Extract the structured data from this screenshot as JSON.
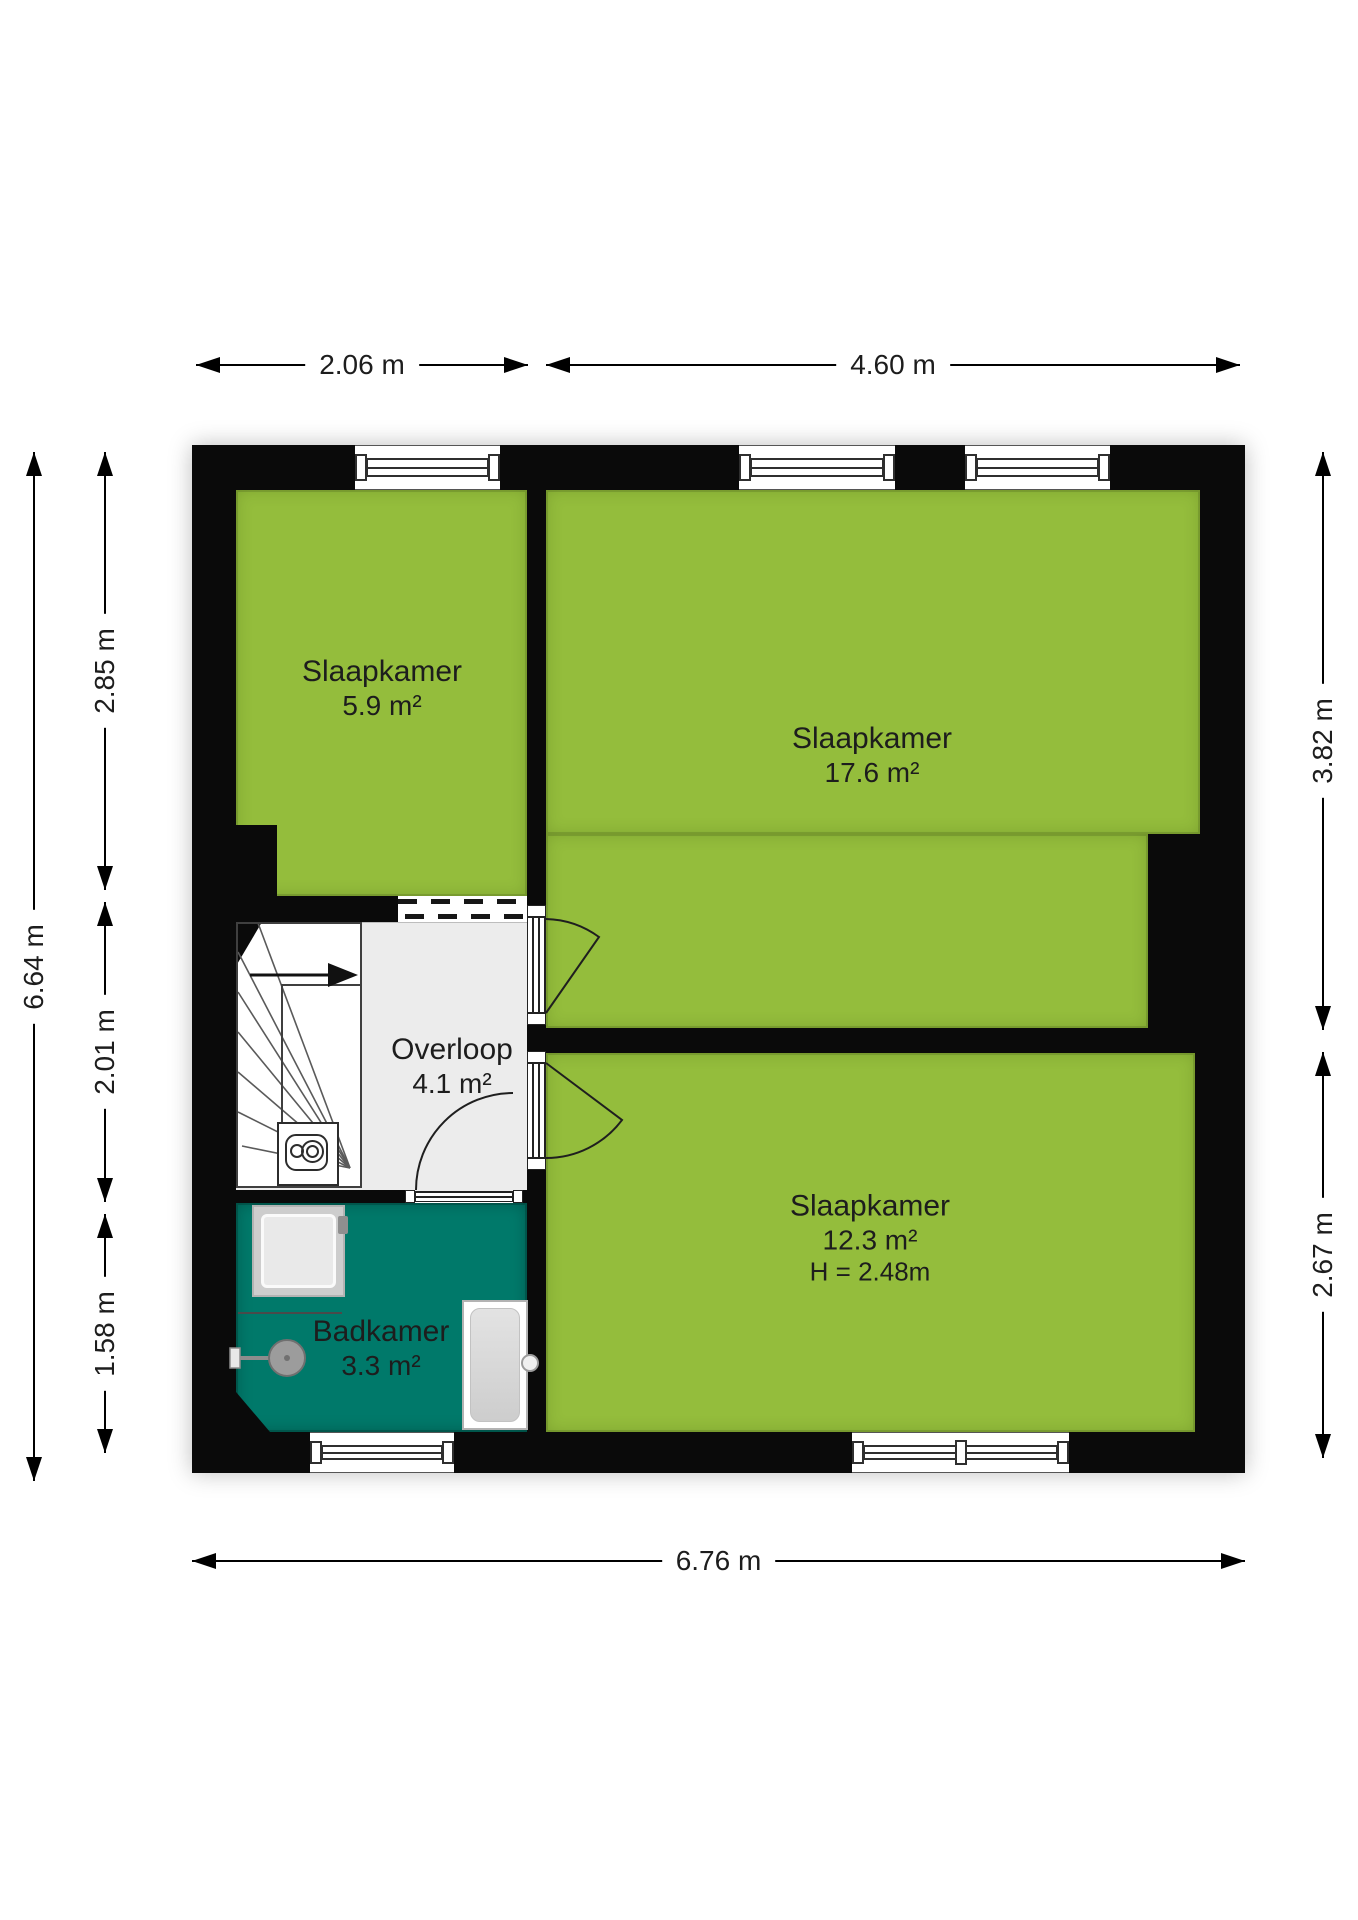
{
  "rooms": [
    {
      "name": "Slaapkamer",
      "area": "5.9 m²"
    },
    {
      "name": "Slaapkamer",
      "area": "17.6 m²"
    },
    {
      "name": "Slaapkamer",
      "area": "12.3 m²",
      "ceiling_height": "H = 2.48m"
    },
    {
      "name": "Overloop",
      "area": "4.1 m²"
    },
    {
      "name": "Badkamer",
      "area": "3.3 m²"
    }
  ],
  "dimensions": {
    "top": [
      "2.06 m",
      "4.60 m"
    ],
    "bottom": [
      "6.76 m"
    ],
    "left_outer": [
      "6.64 m"
    ],
    "left_inner": [
      "2.85 m",
      "2.01 m",
      "1.58 m"
    ],
    "right": [
      "3.82 m",
      "2.67 m"
    ]
  },
  "icons": {
    "stairs_direction": "arrow-right-up-stairs",
    "boiler": "boiler-unit",
    "shower": "shower-tray",
    "washbasin": "round-basin-with-tap",
    "bathtub": "bathtub-with-tap"
  },
  "colors": {
    "room_green": "#94bd3c",
    "bathroom_teal": "#00796a",
    "landing_grey": "#ececec",
    "wall_black": "#0a0a0a"
  }
}
